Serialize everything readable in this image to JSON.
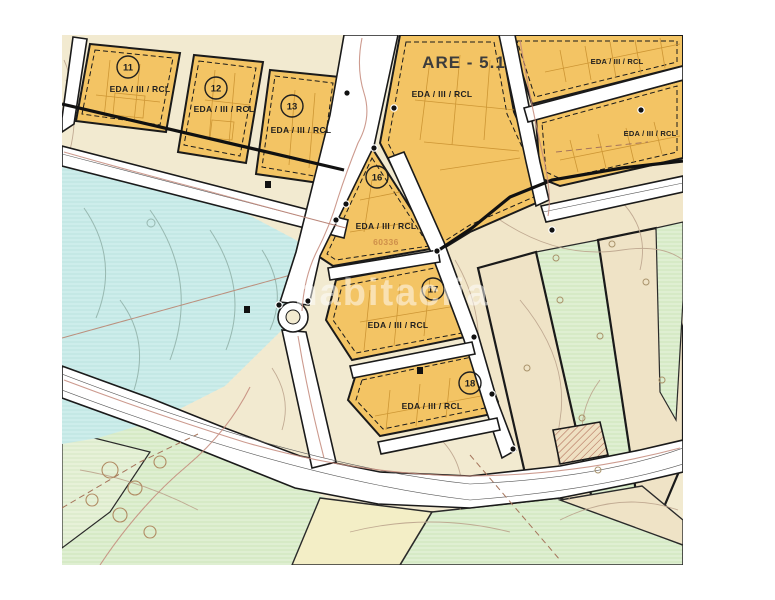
{
  "map": {
    "title": "ARE - 5.1",
    "watermark": "habitaclia",
    "parcels": [
      {
        "number": "11",
        "zone": "EDA / III / RCL"
      },
      {
        "number": "12",
        "zone": "EDA / III / RCL"
      },
      {
        "number": "13",
        "zone": "EDA / III / RCL"
      },
      {
        "number": "16",
        "zone": "EDA / III / RCL",
        "ref": "60336"
      },
      {
        "number": "17",
        "zone": "EDA / III / RCL"
      },
      {
        "number": "18",
        "zone": "EDA / III / RCL"
      }
    ],
    "areas": [
      {
        "location": "are-main",
        "zone": "EDA / III / RCL"
      },
      {
        "location": "northeast-upper",
        "zone": "EDA / III / RCL"
      },
      {
        "location": "northeast-lower",
        "zone": "EDA / III / RCL"
      }
    ],
    "colors": {
      "parcel_orange": "#F3C464",
      "water_blue": "#CDEDEB",
      "green_area": "#DFEFD2",
      "beige_area": "#F1E6C9",
      "cream_base": "#F2EAD0",
      "road_white": "#FFFFFF",
      "boundary_black": "#1A1A1A",
      "contour_brown": "#BCA48D",
      "track_red": "#C4897B",
      "ref_orange": "#CE8F4A"
    }
  }
}
